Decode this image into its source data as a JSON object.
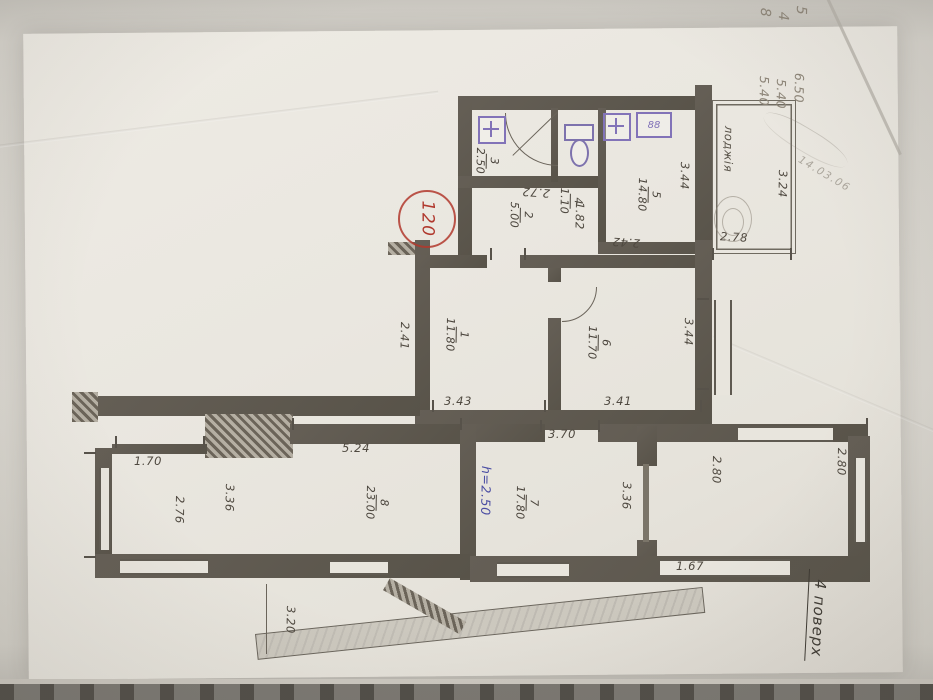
{
  "plan": {
    "stamp_number": "120",
    "floor_note": "4 поверх",
    "date_note": "14.03.06",
    "loggia_label": "лоджія",
    "height_note": "h=2.50",
    "stove_label": "88"
  },
  "pencil_notes": {
    "digits": [
      "8",
      "4",
      "5"
    ],
    "totals": [
      "5.40",
      "5.40",
      "6.50"
    ]
  },
  "rooms": [
    {
      "num": "3",
      "area": "2.50"
    },
    {
      "num": "4",
      "area": "1.10"
    },
    {
      "num": "2",
      "area": "5.00"
    },
    {
      "num": "5",
      "area": "14.80"
    },
    {
      "num": "1",
      "area": "11.80"
    },
    {
      "num": "6",
      "area": "11.70"
    },
    {
      "num": "8",
      "area": "23.00"
    },
    {
      "num": "7",
      "area": "17.80"
    }
  ],
  "dims": {
    "bath_width": "2.72",
    "hall_width": "1.82",
    "kitchen_width": "2.42",
    "kitchen_length": "3.44",
    "loggia_length": "3.24",
    "loggia_width": "2.78",
    "room1_width": "2.41",
    "room1_length": "3.43",
    "room6_length": "3.41",
    "room6_width": "3.44",
    "room7_top": "3.70",
    "room8_top": "5.24",
    "niche_width": "1.70",
    "room8_side": "2.76",
    "room8_width": "3.36",
    "room7_width": "3.36",
    "right_room_width": "2.80",
    "right_room_side": "2.80",
    "bottom_right": "1.67",
    "balcony_width": "3.20"
  }
}
